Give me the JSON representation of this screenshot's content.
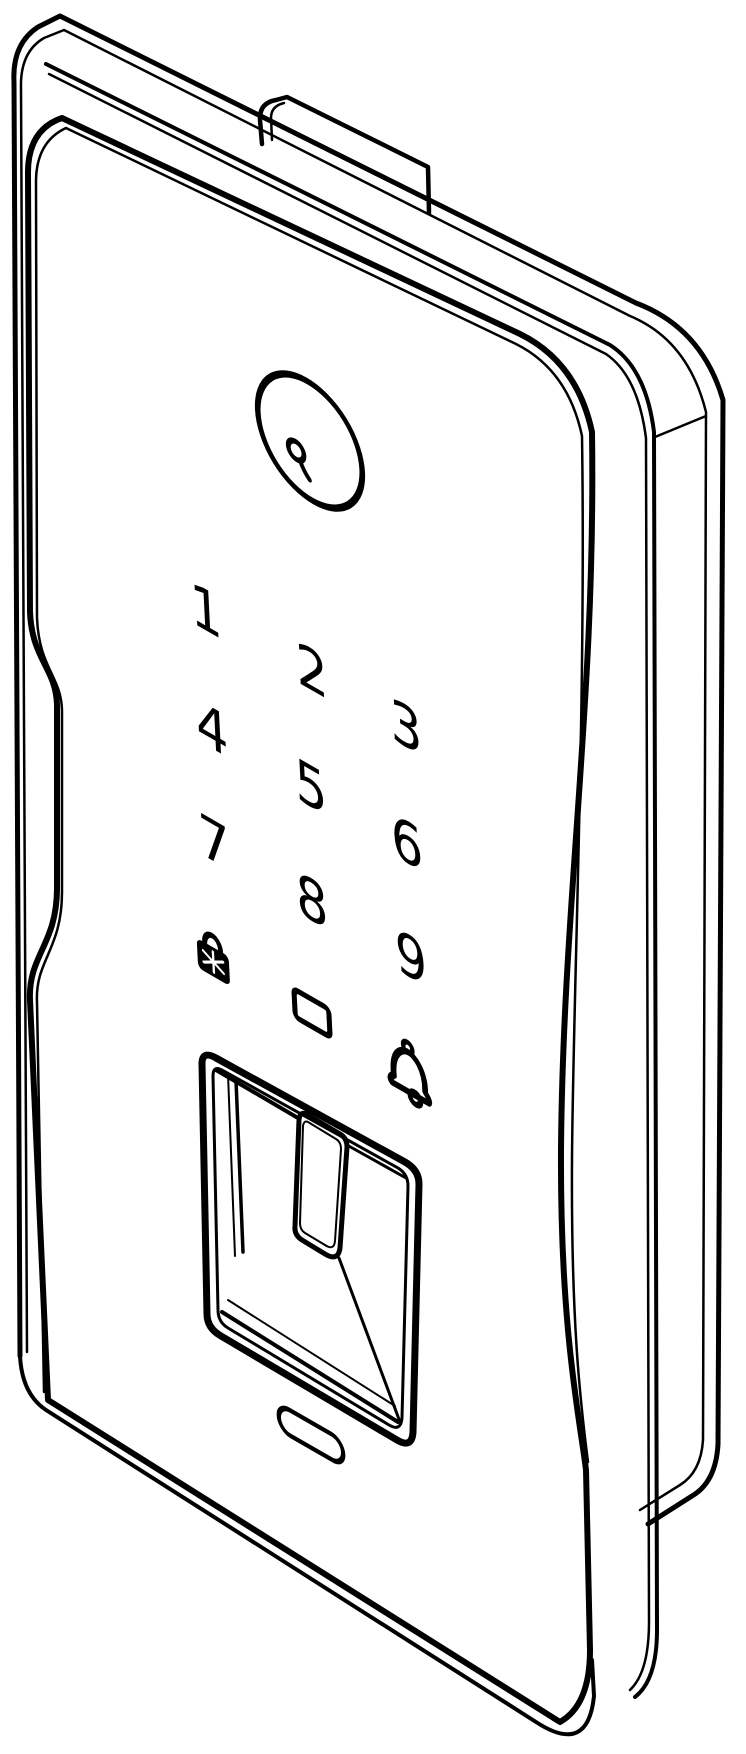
{
  "figure": {
    "kind": "isometric technical line drawing",
    "background_color": "#ffffff",
    "line_color": "#000000"
  },
  "lock": {
    "user_button": {
      "icon": "person-icon",
      "label": ""
    },
    "keypad": {
      "keys": [
        {
          "id": "key-1",
          "label": "1"
        },
        {
          "id": "key-2",
          "label": "2"
        },
        {
          "id": "key-3",
          "label": "3"
        },
        {
          "id": "key-4",
          "label": "4"
        },
        {
          "id": "key-5",
          "label": "5"
        },
        {
          "id": "key-6",
          "label": "6"
        },
        {
          "id": "key-7",
          "label": "7"
        },
        {
          "id": "key-8",
          "label": "8"
        },
        {
          "id": "key-9",
          "label": "9"
        }
      ],
      "lock_key": {
        "icon": "padlock-icon",
        "label": ""
      },
      "blank_key": {
        "icon": "blank-square-key",
        "label": ""
      },
      "bell_key": {
        "icon": "doorbell-icon",
        "label": ""
      }
    },
    "fingerprint_scanner": {
      "label": ""
    },
    "indicator_window": {
      "label": ""
    }
  }
}
